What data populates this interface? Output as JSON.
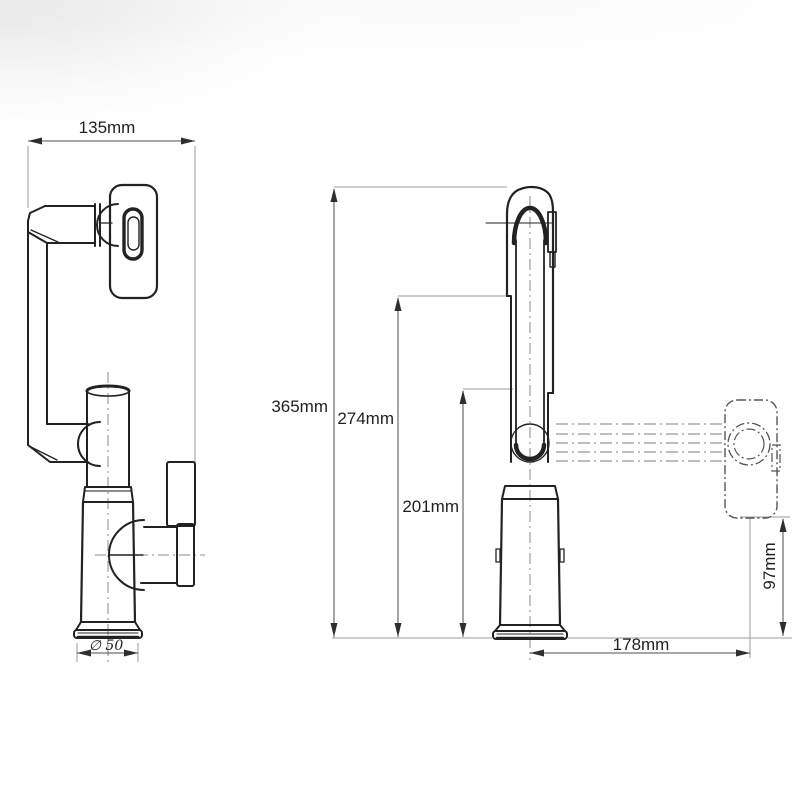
{
  "page": {
    "background_color": "#ffffff"
  },
  "drawing": {
    "kind": "two-view dimensioned engineering drawing of a pull-out faucet",
    "colors": {
      "outline": "#222222",
      "dimension_line": "#4d4d4d",
      "extension_line": "#9b9b9b",
      "centerline": "#8a8a8a",
      "dashed_alternate": "#555555",
      "text": "#222222"
    },
    "dimensions": {
      "side_view_width": "135mm",
      "overall_height": "365mm",
      "spout_top_height": "274mm",
      "outlet_height": "201mm",
      "spray_head_height": "97mm",
      "horizontal_reach": "178mm",
      "base_diameter": "∅ 50"
    }
  }
}
